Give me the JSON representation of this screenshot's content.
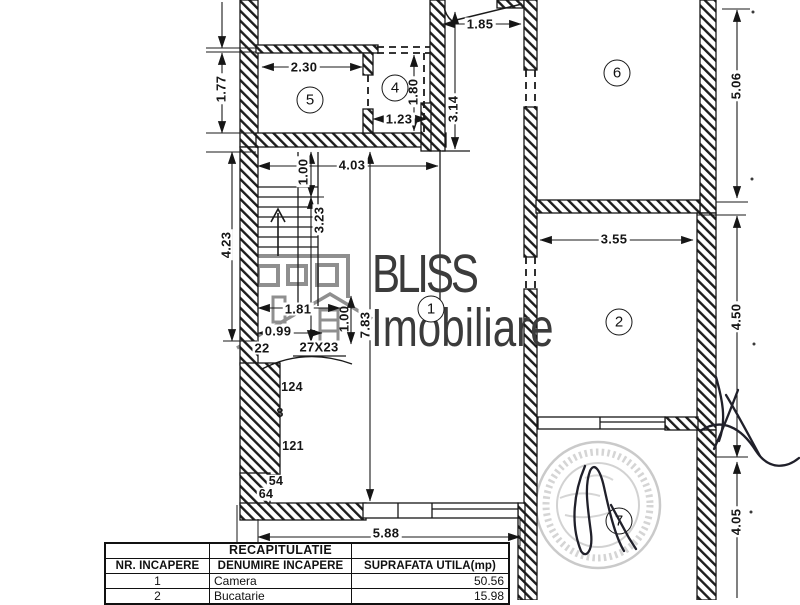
{
  "drawing": {
    "type": "floor-plan",
    "watermark": {
      "line1": "BLISS",
      "line2": "Imobiliare"
    },
    "room_numbers": {
      "r1": "1",
      "r2": "2",
      "r4": "4",
      "r5": "5",
      "r6": "6",
      "r7": "7"
    },
    "dimensions": {
      "d185": "1.85",
      "d230": "2.30",
      "d177": "1.77",
      "d123": "1.23",
      "d180": "1.80",
      "d314": "3.14",
      "d506": "5.06",
      "d403": "4.03",
      "d100a": "1.00",
      "d323": "3.23",
      "d423": "4.23",
      "d355": "3.55",
      "d450": "4.50",
      "d783": "7.83",
      "d100b": "1.00",
      "d181": "1.81",
      "d099": "0.99",
      "d588": "5.88",
      "d405": "4.05"
    },
    "stair_labels": {
      "tread": "27X23",
      "mark22": "22"
    },
    "level_marks": {
      "m124": "124",
      "m8": "8",
      "m121": "121",
      "m54": "54",
      "m64": "64"
    }
  },
  "table": {
    "title": "RECAPITULATIE",
    "headers": [
      "NR. INCAPERE",
      "DENUMIRE INCAPERE",
      "SUPRAFATA UTILA(mp)"
    ],
    "rows": [
      {
        "nr": "1",
        "name": "Camera",
        "area": "50.56"
      },
      {
        "nr": "2",
        "name": "Bucatarie",
        "area": "15.98"
      }
    ]
  },
  "colors": {
    "ink": "#1a1a1a",
    "watermark_text": "#3b3b3b",
    "watermark_logo": "#8f8f8f",
    "stamp": "#787878",
    "pen": "#20202a",
    "paper": "#ffffff"
  }
}
